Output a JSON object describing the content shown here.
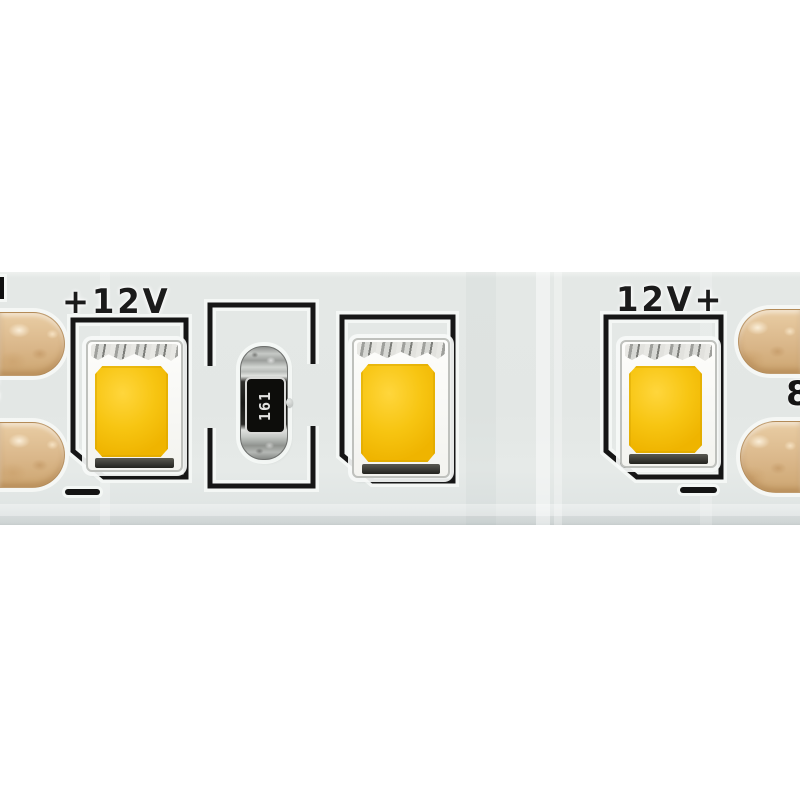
{
  "photo": {
    "labels": {
      "left_polarity": "+12V",
      "right_polarity": "12V+"
    },
    "resistor_marking": "161",
    "edge_glyph_left": "8",
    "edge_glyph_right": "8",
    "colors": {
      "background": "#ffffff",
      "pcb_strip": "#e4e8e6",
      "silkscreen": "#1b1b1b",
      "copper_pad": "#dcbc92",
      "led_phosphor": "#f6c410",
      "led_package": "#f8f8f5",
      "resistor_body": "#1d1d1b",
      "resistor_cap": "#c3c6c4"
    }
  }
}
